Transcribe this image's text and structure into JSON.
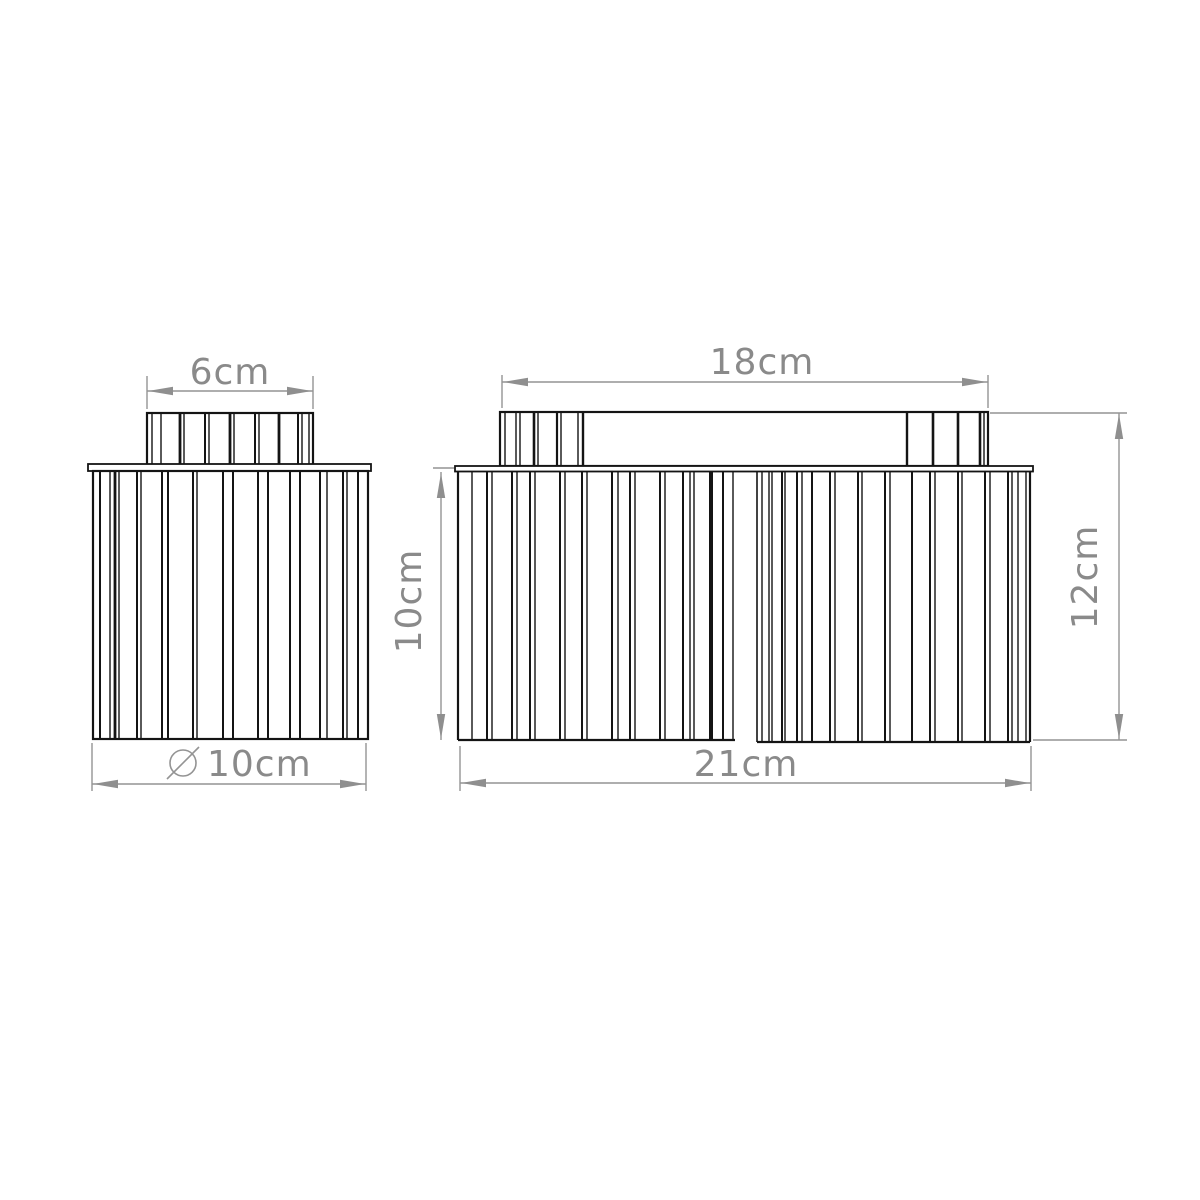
{
  "title": "Pleated lamp shade dimension drawing",
  "colors": {
    "background": "#ffffff",
    "drawing_line": "#141414",
    "dimension_line": "#949494",
    "dimension_text": "#8a8a8a"
  },
  "views": {
    "left": {
      "name": "Single shade side view",
      "dimensions": {
        "top_width": {
          "label": "6cm"
        },
        "diameter": {
          "symbol": "⌀",
          "label": "10cm"
        }
      }
    },
    "right": {
      "name": "Twin shade side view",
      "dimensions": {
        "top_width": {
          "label": "18cm"
        },
        "shade_height": {
          "label": "10cm"
        },
        "total_height": {
          "label": "12cm"
        },
        "total_width": {
          "label": "21cm"
        }
      }
    }
  }
}
